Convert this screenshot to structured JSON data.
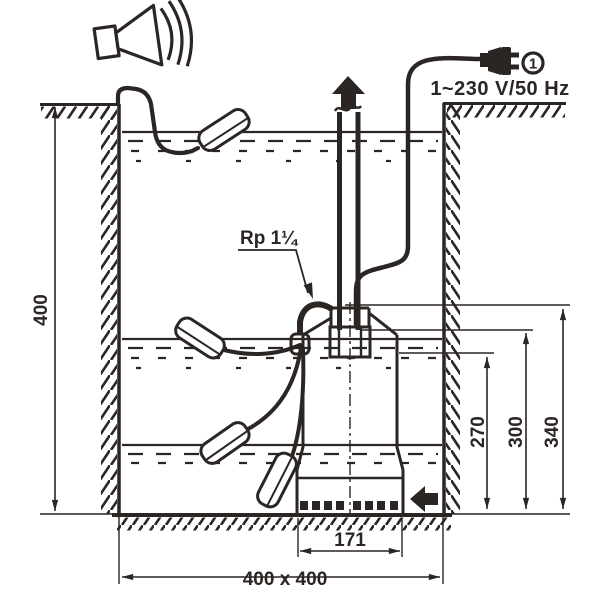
{
  "labels": {
    "power": "1~230 V/50 Hz",
    "phase": "1",
    "connection": "Rp 1¼",
    "depth": "400",
    "level_low": "270",
    "level_mid": "300",
    "level_high": "340",
    "pump_width": "171",
    "pit_size": "400 x 400"
  },
  "colors": {
    "line": "#2b2523",
    "background": "#ffffff"
  },
  "icons": {
    "alarm": "horn-speaker-icon",
    "power": "mains-plug-icon",
    "flow": "up-arrow-icon",
    "inlet": "left-arrow-icon"
  }
}
